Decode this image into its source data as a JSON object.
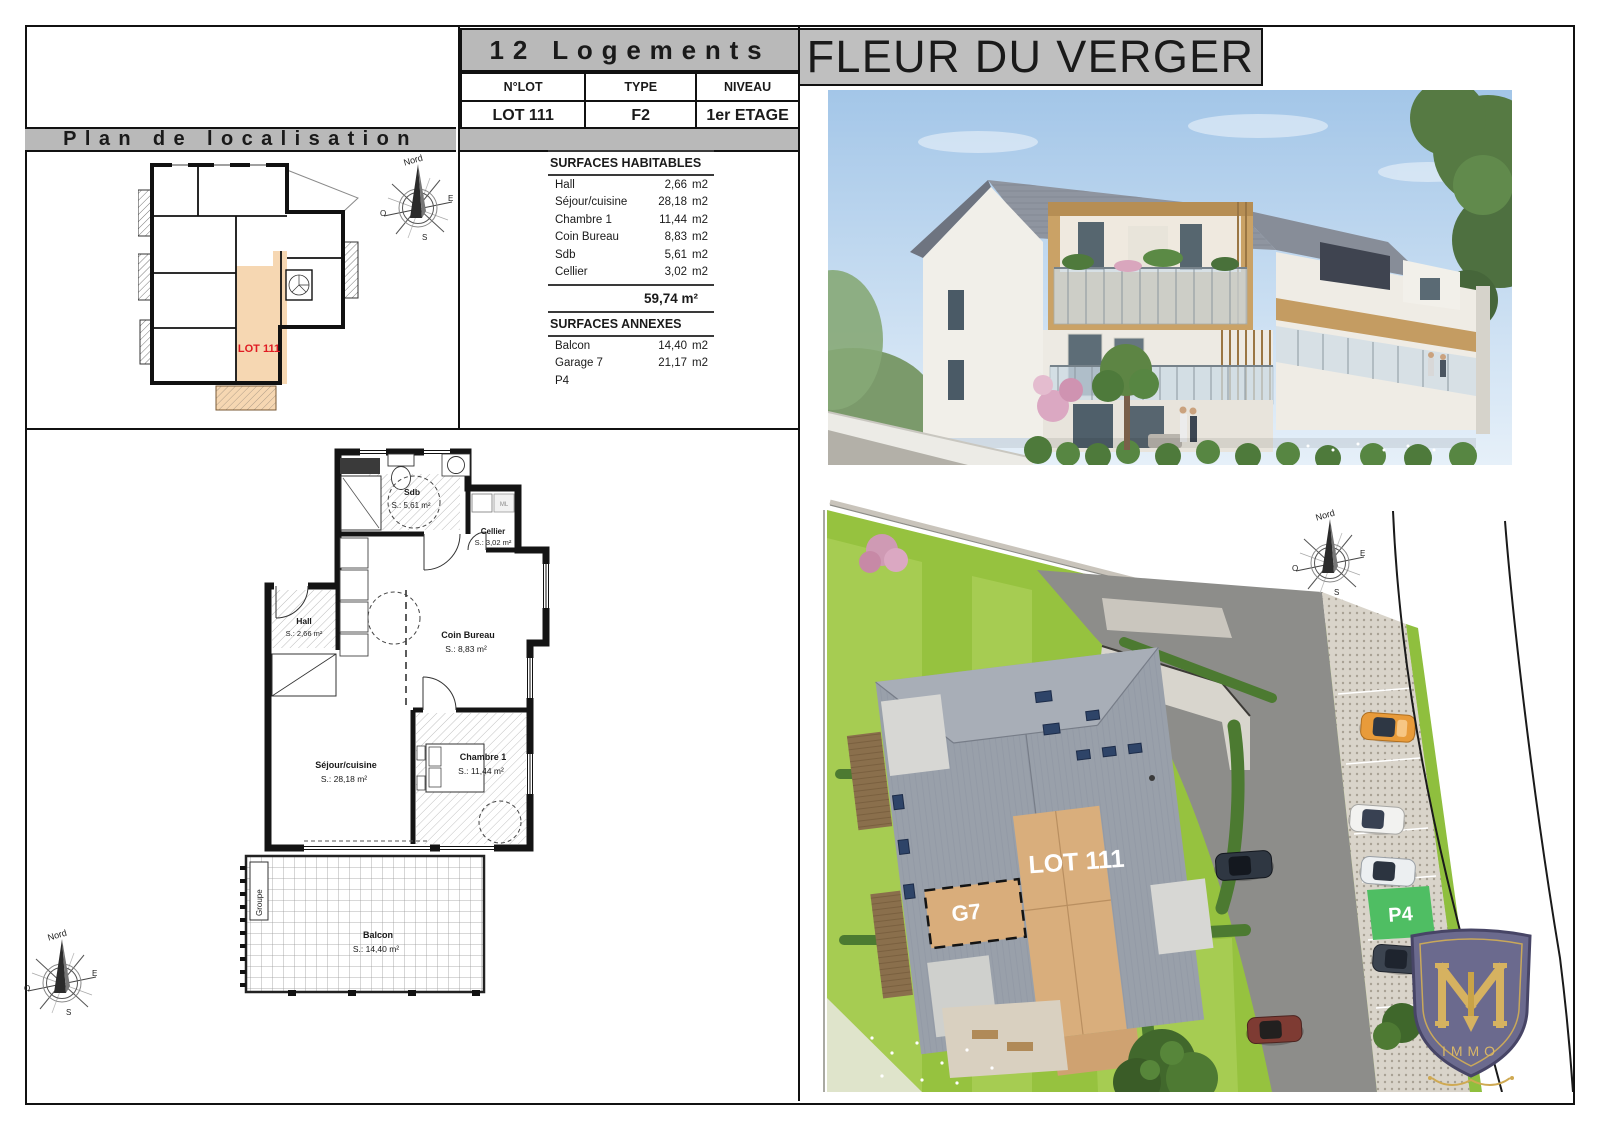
{
  "header": {
    "building_title": "12 Logements",
    "project_title": "FLEUR DU VERGER",
    "lot_table": {
      "col_lot": "N°LOT",
      "col_type": "TYPE",
      "col_level": "NIVEAU",
      "lot": "LOT 111",
      "type": "F2",
      "level": "1er ETAGE"
    }
  },
  "localisation": {
    "title": "Plan de localisation",
    "lot_label": "LOT 111"
  },
  "compass": {
    "north": "Nord",
    "east": "E",
    "west": "O",
    "south": "S"
  },
  "surfaces": {
    "habitables_title": "SURFACES HABITABLES",
    "habitables": [
      {
        "label": "Hall",
        "value": "2,66",
        "unit": "m2"
      },
      {
        "label": "Séjour/cuisine",
        "value": "28,18",
        "unit": "m2"
      },
      {
        "label": "Chambre 1",
        "value": "11,44",
        "unit": "m2"
      },
      {
        "label": "Coin Bureau",
        "value": "8,83",
        "unit": "m2"
      },
      {
        "label": "Sdb",
        "value": "5,61",
        "unit": "m2"
      },
      {
        "label": "Cellier",
        "value": "3,02",
        "unit": "m2"
      }
    ],
    "total_label": "59,74 m²",
    "annexes_title": "SURFACES ANNEXES",
    "annexes": [
      {
        "label": "Balcon",
        "value": "14,40",
        "unit": "m2"
      },
      {
        "label": "Garage 7",
        "value": "21,17",
        "unit": "m2"
      },
      {
        "label": "P4",
        "value": "",
        "unit": ""
      }
    ]
  },
  "floorplan": {
    "rooms": {
      "sdb": {
        "name": "Sdb",
        "area": "S.: 5,61 m²"
      },
      "cellier": {
        "name": "Cellier",
        "area": "S.: 3,02 m²"
      },
      "hall": {
        "name": "Hall",
        "area": "S.: 2,66 m²"
      },
      "coin_bureau": {
        "name": "Coin Bureau",
        "area": "S.: 8,83 m²"
      },
      "sejour": {
        "name": "Séjour/cuisine",
        "area": "S.: 28,18 m²"
      },
      "chambre": {
        "name": "Chambre 1",
        "area": "S.: 11,44 m²"
      },
      "balcon": {
        "name": "Balcon",
        "area": "S.: 14,40 m²"
      }
    },
    "ml_label": "ML",
    "groupe_label": "Groupe"
  },
  "siteplan": {
    "lot_label": "LOT 111",
    "garage_label": "G7",
    "parking_label": "P4"
  },
  "logo": {
    "caption": "IMMO"
  },
  "colors": {
    "band_gray": "#b9b9b9",
    "lot_fill": "#f6d7b2",
    "lot_text_red": "#e01b22",
    "parking_green": "#4fbe63",
    "garage_tan": "#d9ad7b",
    "roof_gray": "#99a0aa",
    "grass_green": "#96c23f"
  }
}
